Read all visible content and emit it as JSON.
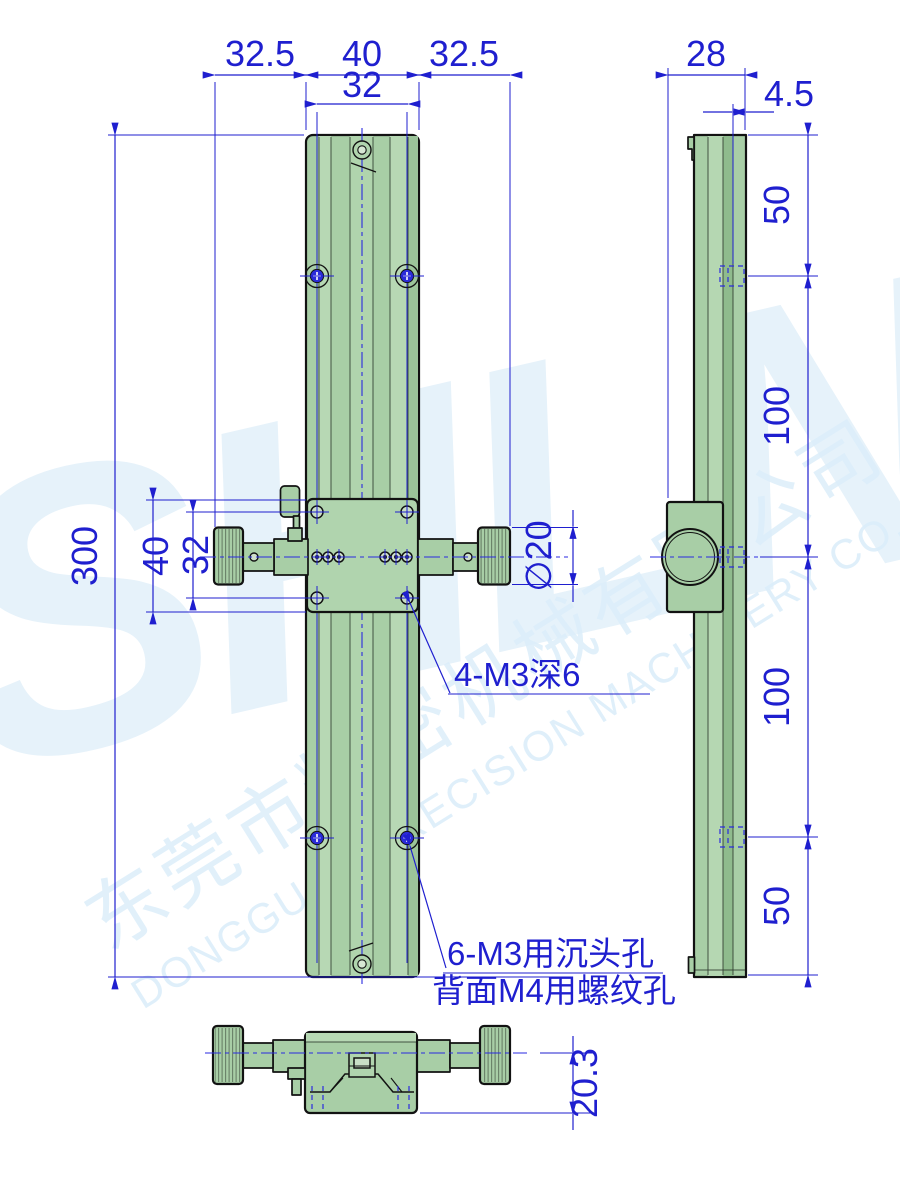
{
  "drawing": {
    "front_view": {
      "dim_top_left": "32.5",
      "dim_top_middle": "40",
      "dim_top_right": "32.5",
      "dim_top_inner": "32",
      "dim_overall_height": "300",
      "dim_carriage_height": "40",
      "dim_carriage_holes": "32",
      "dim_knob_diameter": "∅20",
      "note_carriage_holes": "4-M3深6",
      "note_rail_holes_line1": "6-M3用沉头孔",
      "note_rail_holes_line2": "背面M4用螺纹孔"
    },
    "side_view": {
      "dim_depth": "28",
      "dim_base_thickness": "4.5",
      "dim_hole_top": "50",
      "dim_hole_mid_upper": "100",
      "dim_hole_mid_lower": "100",
      "dim_hole_bottom": "50"
    },
    "bottom_view": {
      "dim_height": "20.3"
    },
    "watermark": {
      "logo": "SHLN",
      "company_cn": "东莞市精密机械有限公司",
      "company_en": "DONGGUAN PRECISION MACHINERY CO.,LTD."
    },
    "colors": {
      "dimension_blue": "#1f1fcf",
      "body_green": "#a8cea6",
      "outline": "#121212",
      "watermark_blue": "#e6f2fa"
    }
  }
}
